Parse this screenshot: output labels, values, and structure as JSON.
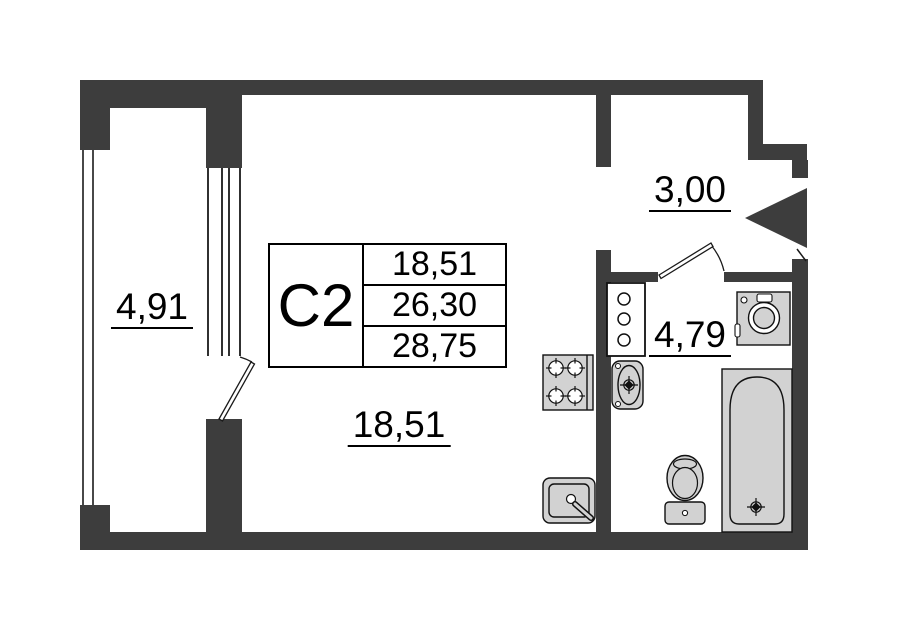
{
  "colors": {
    "wall": "#3d3d3d",
    "fixture": "#d2d2d2",
    "outline": "#111111",
    "thin_line": "#1a1a1a",
    "background": "#ffffff"
  },
  "unit": {
    "code": "С2",
    "living_area": "18,51",
    "total_area": "26,30",
    "total_area_with_balcony": "28,75"
  },
  "room_labels": {
    "balcony": "4,91",
    "hallway": "3,00",
    "bathroom": "4,79",
    "living_room": "18,51"
  },
  "fixtures": {
    "stove": "stove-icon",
    "kitchen_sink": "kitchen-sink-icon",
    "washbasin": "washbasin-icon",
    "toilet": "toilet-icon",
    "bathtub": "bathtub-icon",
    "washing_machine": "washing-machine-icon",
    "cabinet": "cabinet-icon",
    "entrance_arrow": "entrance-arrow-icon"
  }
}
